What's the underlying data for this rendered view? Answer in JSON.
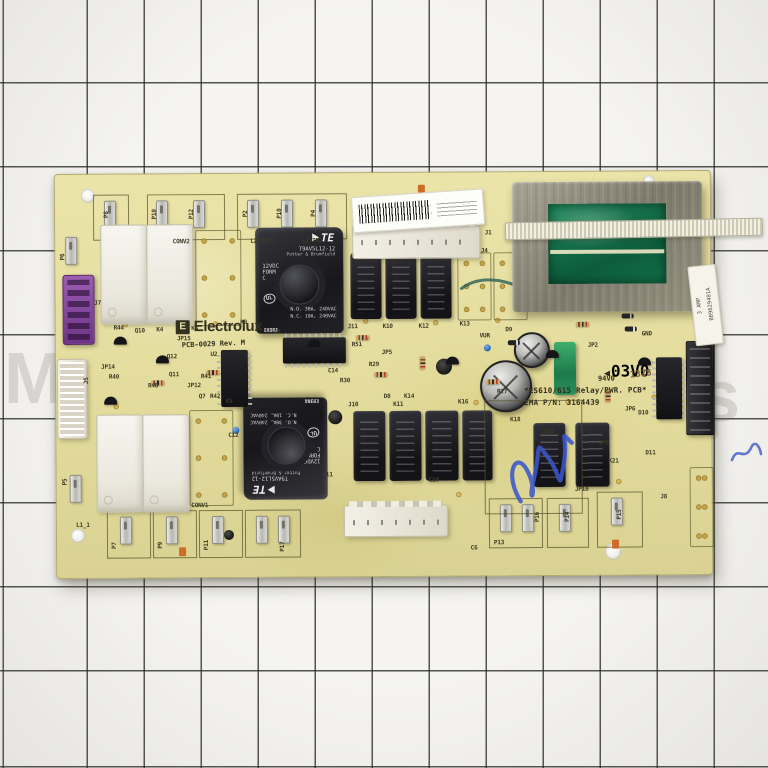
{
  "photo": {
    "watermark_left": "M",
    "watermark_right": "s"
  },
  "colors": {
    "pcb": "#e6dfa0",
    "relay_black": "#1a1a1e",
    "transformer_green": "#156b47",
    "handwriting_blue": "#3b57c9",
    "grid_paper": "#f5f4f1"
  },
  "brand": {
    "logo_mark": "E",
    "logo_text": "Electrolux",
    "pcb_rev": "PCB-0029  Rev. M"
  },
  "board_text": {
    "title": "*ES610/615 Relay/PWR. PCB*",
    "part": "EMA P/N: 3164439",
    "flam": "94V0",
    "date_stamp": "1328",
    "cert": "03V0"
  },
  "relay": {
    "logo": "TE",
    "model": "T9AV5L12-12",
    "maker": "Potter & Brumfield",
    "coil": "12VDC\nFORM\nC",
    "ul": "UL",
    "rating_no": "N.O. 30A, 240VAC",
    "rating_nc": "N.C. 10A, 240VAC",
    "code": "13302",
    "origin": "CHINA"
  },
  "transformer": {
    "label_amp": "3 AMP",
    "label_code": "BB9629401A"
  },
  "silk_labels": [
    {
      "t": "P8",
      "x": 52,
      "y": 40,
      "v": 1
    },
    {
      "t": "P10",
      "x": 100,
      "y": 40,
      "v": 1
    },
    {
      "t": "P12",
      "x": 137,
      "y": 40,
      "v": 1
    },
    {
      "t": "CONV2",
      "x": 126,
      "y": 68,
      "v": 0
    },
    {
      "t": "P2",
      "x": 191,
      "y": 40,
      "v": 1
    },
    {
      "t": "P10",
      "x": 225,
      "y": 40,
      "v": 1
    },
    {
      "t": "P4",
      "x": 259,
      "y": 40,
      "v": 1
    },
    {
      "t": "L2 OUT2",
      "x": 207,
      "y": 68,
      "v": 0
    },
    {
      "t": "L2 IN2",
      "x": 257,
      "y": 68,
      "v": 0
    },
    {
      "t": "J1",
      "x": 433,
      "y": 61,
      "v": 0
    },
    {
      "t": "J4",
      "x": 429,
      "y": 79,
      "v": 0
    },
    {
      "t": "P6",
      "x": 8,
      "y": 82,
      "v": 1
    },
    {
      "t": "J7",
      "x": 42,
      "y": 129,
      "v": 0
    },
    {
      "t": "J5",
      "x": 31,
      "y": 206,
      "v": 1
    },
    {
      "t": "R44",
      "x": 63,
      "y": 154,
      "v": 0
    },
    {
      "t": "Q10",
      "x": 84,
      "y": 157,
      "v": 0
    },
    {
      "t": "K4",
      "x": 104,
      "y": 156,
      "v": 0
    },
    {
      "t": "K6",
      "x": 139,
      "y": 155,
      "v": 0
    },
    {
      "t": "JP15",
      "x": 128,
      "y": 165,
      "v": 0
    },
    {
      "t": "Q12",
      "x": 116,
      "y": 183,
      "v": 0
    },
    {
      "t": "Q11",
      "x": 118,
      "y": 201,
      "v": 0
    },
    {
      "t": "JP12",
      "x": 138,
      "y": 212,
      "v": 0
    },
    {
      "t": "R41",
      "x": 150,
      "y": 203,
      "v": 0
    },
    {
      "t": "Q7",
      "x": 146,
      "y": 223,
      "v": 0
    },
    {
      "t": "R42",
      "x": 159,
      "y": 223,
      "v": 0
    },
    {
      "t": "K5",
      "x": 173,
      "y": 228,
      "v": 0
    },
    {
      "t": "R48",
      "x": 97,
      "y": 212,
      "v": 0
    },
    {
      "t": "JP14",
      "x": 52,
      "y": 193,
      "v": 0
    },
    {
      "t": "R40",
      "x": 58,
      "y": 203,
      "v": 0
    },
    {
      "t": "U2",
      "x": 158,
      "y": 181,
      "v": 0
    },
    {
      "t": "U1",
      "x": 222,
      "y": 159,
      "v": 0
    },
    {
      "t": "K9",
      "x": 188,
      "y": 149,
      "v": 0
    },
    {
      "t": "J11",
      "x": 297,
      "y": 154,
      "v": 0
    },
    {
      "t": "K10",
      "x": 332,
      "y": 154,
      "v": 0
    },
    {
      "t": "K12",
      "x": 368,
      "y": 154,
      "v": 0
    },
    {
      "t": "K13",
      "x": 409,
      "y": 152,
      "v": 0
    },
    {
      "t": "D9",
      "x": 453,
      "y": 158,
      "v": 0
    },
    {
      "t": "VUR",
      "x": 429,
      "y": 164,
      "v": 0
    },
    {
      "t": "R29",
      "x": 318,
      "y": 192,
      "v": 0
    },
    {
      "t": "C14",
      "x": 277,
      "y": 198,
      "v": 0
    },
    {
      "t": "R30",
      "x": 289,
      "y": 208,
      "v": 0
    },
    {
      "t": "R27",
      "x": 446,
      "y": 220,
      "v": 0
    },
    {
      "t": "JP5",
      "x": 331,
      "y": 180,
      "v": 0
    },
    {
      "t": "R51",
      "x": 301,
      "y": 172,
      "v": 0
    },
    {
      "t": "GND",
      "x": 591,
      "y": 163,
      "v": 0
    },
    {
      "t": "JP2",
      "x": 537,
      "y": 174,
      "v": 0
    },
    {
      "t": "JP6",
      "x": 574,
      "y": 238,
      "v": 0
    },
    {
      "t": "D10",
      "x": 587,
      "y": 242,
      "v": 0
    },
    {
      "t": "D11",
      "x": 594,
      "y": 282,
      "v": 0
    },
    {
      "t": "K21",
      "x": 557,
      "y": 290,
      "v": 0
    },
    {
      "t": "JP9",
      "x": 547,
      "y": 272,
      "v": 0
    },
    {
      "t": "JP10",
      "x": 525,
      "y": 318,
      "v": 0
    },
    {
      "t": "J8",
      "x": 607,
      "y": 326,
      "v": 0
    },
    {
      "t": "K20",
      "x": 493,
      "y": 260,
      "v": 0
    },
    {
      "t": "K18",
      "x": 459,
      "y": 248,
      "v": 0
    },
    {
      "t": "C12",
      "x": 177,
      "y": 262,
      "v": 0
    },
    {
      "t": "C6",
      "x": 417,
      "y": 376,
      "v": 0
    },
    {
      "t": "C10",
      "x": 377,
      "y": 308,
      "v": 0
    },
    {
      "t": "C11",
      "x": 271,
      "y": 302,
      "v": 0
    },
    {
      "t": "J10",
      "x": 297,
      "y": 232,
      "v": 0
    },
    {
      "t": "K11",
      "x": 342,
      "y": 232,
      "v": 0
    },
    {
      "t": "K16",
      "x": 407,
      "y": 230,
      "v": 0
    },
    {
      "t": "D8",
      "x": 331,
      "y": 224,
      "v": 0
    },
    {
      "t": "K14",
      "x": 353,
      "y": 224,
      "v": 0
    },
    {
      "t": "CONV1",
      "x": 143,
      "y": 332,
      "v": 0
    },
    {
      "t": "P7",
      "x": 58,
      "y": 371,
      "v": 1
    },
    {
      "t": "P9",
      "x": 104,
      "y": 371,
      "v": 1
    },
    {
      "t": "P11",
      "x": 150,
      "y": 371,
      "v": 1
    },
    {
      "t": "P17",
      "x": 226,
      "y": 373,
      "v": 1
    },
    {
      "t": "L1_1",
      "x": 26,
      "y": 351,
      "v": 0
    },
    {
      "t": "P5",
      "x": 9,
      "y": 307,
      "v": 1
    },
    {
      "t": "P13",
      "x": 442,
      "y": 371,
      "v": 0
    },
    {
      "t": "P16",
      "x": 481,
      "y": 345,
      "v": 1
    },
    {
      "t": "P14",
      "x": 511,
      "y": 345,
      "v": 1
    },
    {
      "t": "P15",
      "x": 563,
      "y": 343,
      "v": 1
    }
  ]
}
